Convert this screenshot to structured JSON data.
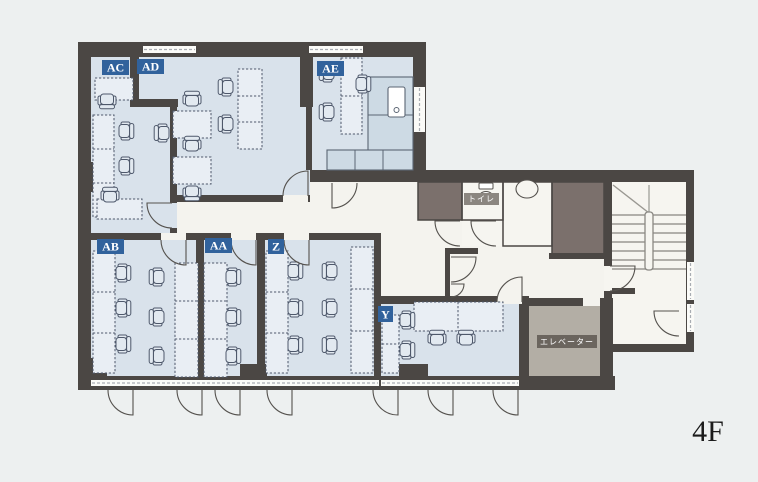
{
  "floor": {
    "indicator": "4F"
  },
  "rooms": [
    {
      "label": "AC"
    },
    {
      "label": "AD"
    },
    {
      "label": "AE"
    },
    {
      "label": "AB"
    },
    {
      "label": "AA"
    },
    {
      "label": "Z"
    },
    {
      "label": "Y"
    }
  ],
  "facilities": [
    {
      "label": "トイレ"
    },
    {
      "label": "エレベーター"
    }
  ],
  "colors": {
    "background": "#edf0f0",
    "wall": "#4b4744",
    "office_floor": "#d9e2eb",
    "corridor_floor": "#f4f3ee",
    "stair_floor": "#f6f5f0",
    "utility_room": "#7b706c",
    "elevator_cab": "#b3aea5",
    "desk_fill": "#e9eef4",
    "counter_fill": "#cddae4",
    "furniture_line": "#4e586b",
    "door_line": "#55524e",
    "room_badge": "#31629c",
    "toilet_badge": "#8b8680",
    "elevator_badge": "#6b655e"
  }
}
